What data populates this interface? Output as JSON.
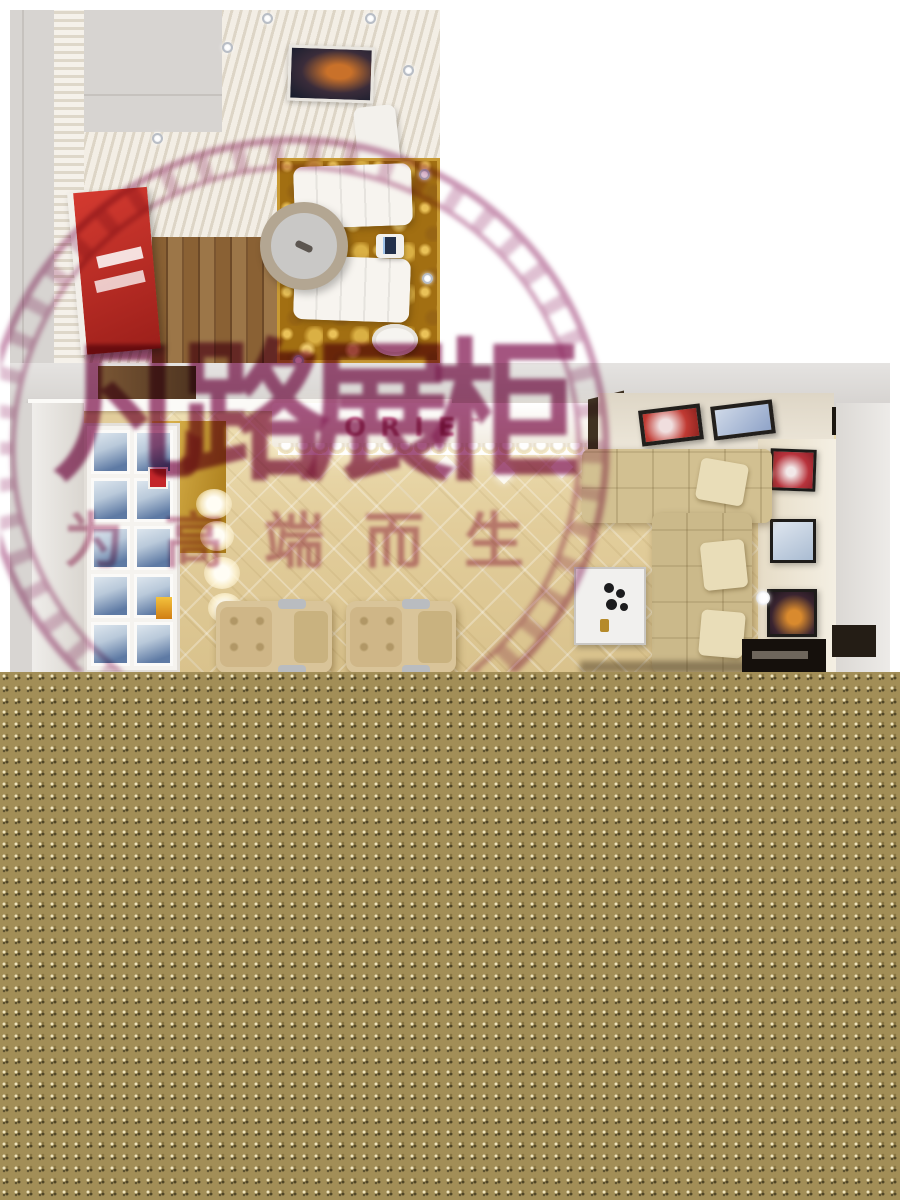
{
  "watermark": {
    "title": "凡路展柜",
    "subtitle": "为高端而生",
    "text_color": "#8d2a60",
    "ring_color": "#96336b"
  },
  "salon": {
    "wall_sign": "ORIE",
    "sign_mark": "™"
  },
  "palette": {
    "page_bg": "#ffffff",
    "bottom_texture": "#a28e57",
    "gold_carpet": "#b07c16",
    "wood_floor": "#83603a",
    "red_artwork": "#c1342c",
    "salon_floor": "#e2cd9b",
    "wall_grey": "#d7d4d1",
    "sofa_beige": "#d2c091"
  }
}
